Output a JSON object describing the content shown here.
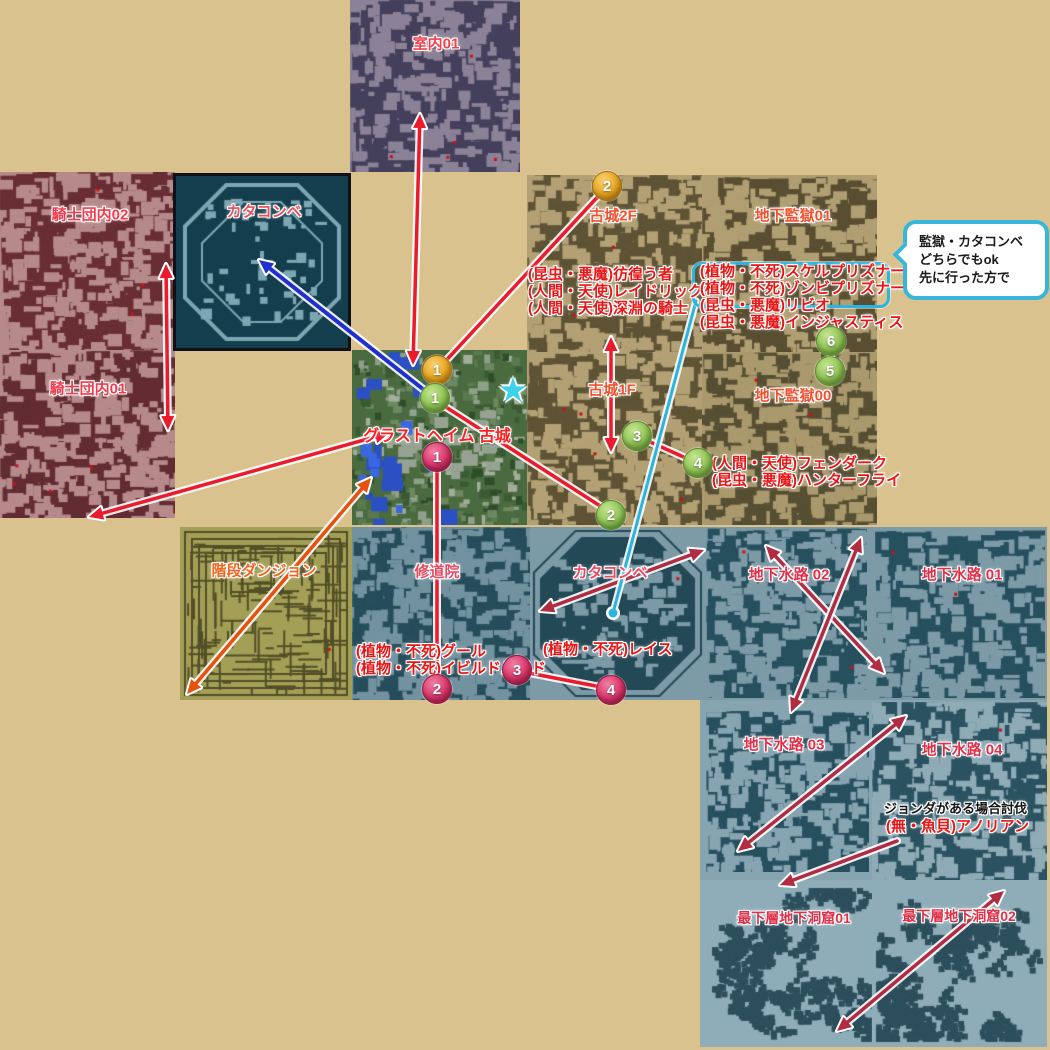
{
  "page": {
    "width": 1050,
    "height": 1050,
    "bg": "#d9c28e",
    "description": "Glast Heim dungeon connection map guide"
  },
  "palette": {
    "red_arrow": "#ea1b2c",
    "crimson_arrow": "#b12c42",
    "orange_arrow": "#e8500e",
    "blue_arrow": "#2030d0",
    "cyan": "#2ab4e0"
  },
  "regions": [
    {
      "name": "region-blue-strip",
      "x": 352,
      "y": 527,
      "w": 695,
      "h": 173,
      "bg": "#7d9aa7"
    },
    {
      "name": "region-sewer-lower",
      "x": 700,
      "y": 700,
      "w": 347,
      "h": 181,
      "bg": "#87a4b1"
    },
    {
      "name": "region-lowest-cave",
      "x": 700,
      "y": 880,
      "w": 347,
      "h": 167,
      "bg": "#8fadb8"
    }
  ],
  "tiles": [
    {
      "name": "room-interior-01",
      "label": "室内01",
      "x": 350,
      "y": 0,
      "w": 170,
      "h": 172,
      "bg": "#8c8297",
      "fg": "#44405c",
      "pattern": "rooms",
      "density": 1.15,
      "dots": 5,
      "lx": 436,
      "ly": 43,
      "lcolor": "#f5404e",
      "lsize": 15
    },
    {
      "name": "knights-hall-02",
      "label": "騎士団内02",
      "x": 0,
      "y": 172,
      "w": 175,
      "h": 178,
      "bg": "#b68a8a",
      "fg": "#682e34",
      "pattern": "rooms",
      "density": 1.35,
      "dots": 3,
      "lx": 90,
      "ly": 214,
      "lcolor": "#f23b4e",
      "lsize": 15
    },
    {
      "name": "knights-hall-01",
      "label": "騎士団内01",
      "x": 0,
      "y": 350,
      "w": 175,
      "h": 168,
      "bg": "#b68a8a",
      "fg": "#622c32",
      "pattern": "rooms",
      "density": 1.35,
      "dots": 4,
      "lx": 88,
      "ly": 388,
      "lcolor": "#f23b4e",
      "lsize": 15
    },
    {
      "name": "catacomb-upper",
      "label": "カタコンベ",
      "x": 176,
      "y": 176,
      "w": 172,
      "h": 172,
      "bg": "#143e4d",
      "fg": "#7ca6b2",
      "pattern": "oct-stroke",
      "dots": 0,
      "border": "3px solid #101018",
      "lx": 264,
      "ly": 211,
      "lcolor": "#e8505e",
      "lsize": 15
    },
    {
      "name": "castle-2f",
      "label": "古城2F",
      "x": 527,
      "y": 175,
      "w": 175,
      "h": 177,
      "bg": "#b3a175",
      "fg": "#5e5335",
      "pattern": "rooms",
      "density": 1.25,
      "dots": 3,
      "lx": 613,
      "ly": 215,
      "lcolor": "#f3502e",
      "lsize": 15
    },
    {
      "name": "underprison-01",
      "label": "地下監獄01",
      "x": 702,
      "y": 175,
      "w": 175,
      "h": 177,
      "bg": "#b09f72",
      "fg": "#594e32",
      "pattern": "rooms",
      "density": 1.25,
      "dots": 3,
      "lx": 793,
      "ly": 215,
      "lcolor": "#f3502e",
      "lsize": 15
    },
    {
      "name": "castle-1f",
      "label": "古城1F",
      "x": 527,
      "y": 352,
      "w": 175,
      "h": 173,
      "bg": "#b3a175",
      "fg": "#5e5335",
      "pattern": "rooms",
      "density": 1.3,
      "dots": 4,
      "lx": 612,
      "ly": 389,
      "lcolor": "#f3502e",
      "lsize": 15
    },
    {
      "name": "underprison-00",
      "label": "地下監獄00",
      "x": 702,
      "y": 352,
      "w": 175,
      "h": 173,
      "bg": "#aa996d",
      "fg": "#564f33",
      "pattern": "rooms",
      "density": 1.3,
      "dots": 2,
      "lx": 793,
      "ly": 395,
      "lcolor": "#f3502e",
      "lsize": 15
    },
    {
      "name": "glast-heim-castle",
      "label": "グラストヘイム 古城",
      "x": 352,
      "y": 350,
      "w": 175,
      "h": 175,
      "bg": "#4a6a40",
      "fg": "#3b5a33",
      "pattern": "glast",
      "dots": 0,
      "lx": 437,
      "ly": 434,
      "lcolor": "#ff2020",
      "lsize": 16
    },
    {
      "name": "stairs-dungeon",
      "label": "階段ダンジョン",
      "x": 180,
      "y": 527,
      "w": 172,
      "h": 173,
      "bg": "#a49f57",
      "fg": "#514f26",
      "pattern": "maze",
      "dots": 1,
      "lx": 264,
      "ly": 570,
      "lcolor": "#f2641c",
      "lsize": 15
    },
    {
      "name": "monastery",
      "label": "修道院",
      "x": 352,
      "y": 527,
      "w": 178,
      "h": 173,
      "bg": "#7392a0",
      "fg": "#264d5b",
      "pattern": "rooms",
      "density": 1.6,
      "dots": 1,
      "lx": 437,
      "ly": 571,
      "lcolor": "#e84a62",
      "lsize": 15
    },
    {
      "name": "catacomb-lower",
      "label": "カタコンベ",
      "x": 530,
      "y": 527,
      "w": 175,
      "h": 173,
      "bg": "#7d9aa7",
      "fg": "#234856",
      "pattern": "oct-fill",
      "dots": 1,
      "lx": 610,
      "ly": 572,
      "lcolor": "#e84a62",
      "lsize": 15
    },
    {
      "name": "sewer-02",
      "label": "地下水路 02",
      "x": 705,
      "y": 528,
      "w": 162,
      "h": 170,
      "bg": "#7d9aa7",
      "fg": "#26505e",
      "pattern": "rooms",
      "density": 1.5,
      "dots": 2,
      "lx": 789,
      "ly": 574,
      "lcolor": "#e0304a",
      "lsize": 15
    },
    {
      "name": "sewer-01",
      "label": "地下水路 01",
      "x": 875,
      "y": 530,
      "w": 170,
      "h": 168,
      "bg": "#7d9aa7",
      "fg": "#26505e",
      "pattern": "rooms",
      "density": 1.5,
      "dots": 2,
      "lx": 962,
      "ly": 574,
      "lcolor": "#e0304a",
      "lsize": 15
    },
    {
      "name": "sewer-03",
      "label": "地下水路 03",
      "x": 706,
      "y": 710,
      "w": 163,
      "h": 162,
      "bg": "#87a4b1",
      "fg": "#27505f",
      "pattern": "rooms",
      "density": 1.5,
      "dots": 0,
      "lx": 784,
      "ly": 744,
      "lcolor": "#e0304a",
      "lsize": 15
    },
    {
      "name": "sewer-04",
      "label": "地下水路 04",
      "x": 872,
      "y": 702,
      "w": 175,
      "h": 178,
      "bg": "#8fabb6",
      "fg": "#2b5260",
      "pattern": "rooms",
      "density": 1.2,
      "dots": 1,
      "lx": 962,
      "ly": 749,
      "lcolor": "#e0304a",
      "lsize": 15
    },
    {
      "name": "lowest-cave-01",
      "label": "最下層地下洞窟01",
      "x": 708,
      "y": 884,
      "w": 168,
      "h": 162,
      "bg": "#8fadb8",
      "fg": "#2d4f5c",
      "pattern": "cave",
      "dots": 0,
      "lx": 794,
      "ly": 918,
      "lcolor": "#e0304a",
      "lsize": 14
    },
    {
      "name": "lowest-cave-02",
      "label": "最下層地下洞窟02",
      "x": 872,
      "y": 884,
      "w": 175,
      "h": 162,
      "bg": "#8fadb8",
      "fg": "#2d4f5c",
      "pattern": "cave",
      "dots": 0,
      "lx": 959,
      "ly": 916,
      "lcolor": "#e0304a",
      "lsize": 14
    }
  ],
  "monster_notes": [
    {
      "name": "castle-2f-monsters",
      "x": 528,
      "y": 266,
      "color": "#e81616",
      "size": 15,
      "lines": [
        "(昆虫・悪魔)彷徨う者",
        "(人間・天使)レイドリック",
        "(人間・天使)深淵の騎士"
      ]
    },
    {
      "name": "underprison-01-monsters",
      "x": 700,
      "y": 263,
      "color": "#e81616",
      "size": 15,
      "lines": [
        "(植物・不死)スケルプリズナー",
        "(植物・不死)ゾンビプリズナー",
        "(昆虫・悪魔)リビオ",
        "(昆虫・悪魔)インジャスティス"
      ]
    },
    {
      "name": "underprison-00-monsters",
      "x": 712,
      "y": 455,
      "color": "#e81616",
      "size": 15,
      "lines": [
        "(人間・天使)フェンダーク",
        "(昆虫・悪魔)ハンターフライ"
      ]
    },
    {
      "name": "monastery-monsters",
      "x": 356,
      "y": 643,
      "color": "#e81616",
      "size": 15,
      "lines": [
        "(植物・不死)グール",
        "(植物・不死)イビルドルイド"
      ]
    },
    {
      "name": "catacomb-monsters",
      "x": 543,
      "y": 641,
      "color": "#e81616",
      "size": 15,
      "lines": [
        "(植物・不死)レイス"
      ]
    },
    {
      "name": "jonda-note",
      "x": 884,
      "y": 800,
      "color": "#141414",
      "size": 13,
      "lines": [
        "ジョンダがある場合討伐"
      ]
    },
    {
      "name": "anolian-note",
      "x": 886,
      "y": 818,
      "color": "#e81616",
      "size": 15,
      "lines": [
        "(無・魚貝)アノリアン"
      ]
    }
  ],
  "circles": [
    {
      "name": "route-orange-1",
      "x": 437,
      "y": 370,
      "n": "1",
      "c": "orange"
    },
    {
      "name": "route-orange-2",
      "x": 607,
      "y": 186,
      "n": "2",
      "c": "orange"
    },
    {
      "name": "route-green-1",
      "x": 435,
      "y": 398,
      "n": "1",
      "c": "green"
    },
    {
      "name": "route-green-2",
      "x": 611,
      "y": 515,
      "n": "2",
      "c": "green"
    },
    {
      "name": "route-green-3",
      "x": 637,
      "y": 436,
      "n": "3",
      "c": "green"
    },
    {
      "name": "route-green-4",
      "x": 698,
      "y": 463,
      "n": "4",
      "c": "green"
    },
    {
      "name": "route-green-5",
      "x": 830,
      "y": 371,
      "n": "5",
      "c": "green"
    },
    {
      "name": "route-green-6",
      "x": 831,
      "y": 341,
      "n": "6",
      "c": "green"
    },
    {
      "name": "route-pink-1",
      "x": 437,
      "y": 457,
      "n": "1",
      "c": "pink"
    },
    {
      "name": "route-pink-2",
      "x": 437,
      "y": 689,
      "n": "2",
      "c": "pink"
    },
    {
      "name": "route-pink-3",
      "x": 517,
      "y": 670,
      "n": "3",
      "c": "pink"
    },
    {
      "name": "route-pink-4",
      "x": 611,
      "y": 690,
      "n": "4",
      "c": "pink"
    }
  ],
  "arrows": [
    {
      "name": "arrow-castle-interior01",
      "x1": 420,
      "y1": 114,
      "x2": 413,
      "y2": 365,
      "c": "#ea1b2c",
      "heads": "both"
    },
    {
      "name": "arrow-knights02-knights01",
      "x1": 166,
      "y1": 264,
      "x2": 168,
      "y2": 430,
      "c": "#ea1b2c",
      "heads": "both"
    },
    {
      "name": "arrow-castle-knights01",
      "x1": 389,
      "y1": 433,
      "x2": 89,
      "y2": 517,
      "c": "#ea1b2c",
      "heads": "both"
    },
    {
      "name": "line-orange1-orange2",
      "x1": 441,
      "y1": 366,
      "x2": 604,
      "y2": 190,
      "c": "#ea1b2c",
      "heads": "none"
    },
    {
      "name": "line-green1-green2",
      "x1": 438,
      "y1": 402,
      "x2": 608,
      "y2": 511,
      "c": "#ea1b2c",
      "heads": "none"
    },
    {
      "name": "line-green3-green4",
      "x1": 648,
      "y1": 441,
      "x2": 688,
      "y2": 459,
      "c": "#ea1b2c",
      "heads": "none"
    },
    {
      "name": "line-green6-green5",
      "x1": 831,
      "y1": 350,
      "x2": 831,
      "y2": 362,
      "c": "#ea1b2c",
      "heads": "none"
    },
    {
      "name": "arrow-castle2f-castle1f",
      "x1": 611,
      "y1": 337,
      "x2": 611,
      "y2": 452,
      "c": "#ea1b2c",
      "heads": "both"
    },
    {
      "name": "line-pink1-pink2",
      "x1": 437,
      "y1": 470,
      "x2": 437,
      "y2": 678,
      "c": "#ea1b2c",
      "heads": "none"
    },
    {
      "name": "line-pink3-pink4",
      "x1": 529,
      "y1": 673,
      "x2": 601,
      "y2": 687,
      "c": "#ea1b2c",
      "heads": "none"
    },
    {
      "name": "arrow-castle-stairsdungeon",
      "x1": 371,
      "y1": 478,
      "x2": 187,
      "y2": 694,
      "c": "#e8500e",
      "heads": "both"
    },
    {
      "name": "arrow-catacomb-sewer02",
      "x1": 704,
      "y1": 550,
      "x2": 540,
      "y2": 611,
      "c": "#b12c42",
      "heads": "both"
    },
    {
      "name": "arrow-sewer02-sewer01-a",
      "x1": 766,
      "y1": 546,
      "x2": 884,
      "y2": 673,
      "c": "#b12c42",
      "heads": "both"
    },
    {
      "name": "arrow-sewer02-sewer03",
      "x1": 861,
      "y1": 538,
      "x2": 791,
      "y2": 712,
      "c": "#b12c42",
      "heads": "both"
    },
    {
      "name": "arrow-sewer03-sewer04",
      "x1": 906,
      "y1": 716,
      "x2": 738,
      "y2": 851,
      "c": "#b12c42",
      "heads": "both"
    },
    {
      "name": "arrow-sewer04-cave01",
      "x1": 897,
      "y1": 841,
      "x2": 780,
      "y2": 885,
      "c": "#b12c42",
      "heads": "end"
    },
    {
      "name": "arrow-cave01-cave02",
      "x1": 1004,
      "y1": 891,
      "x2": 837,
      "y2": 1031,
      "c": "#b12c42",
      "heads": "both"
    },
    {
      "name": "arrow-castle-catacomb-upper",
      "x1": 433,
      "y1": 397,
      "x2": 259,
      "y2": 260,
      "c": "#2030d0",
      "heads": "end",
      "w": 4
    },
    {
      "name": "line-bracket-wraith",
      "x1": 696,
      "y1": 301,
      "x2": 613,
      "y2": 613,
      "c": "#2ab4e0",
      "heads": "none",
      "dot": true,
      "w": 3
    }
  ],
  "bracket": {
    "name": "prisoner-highlight-bracket",
    "x": 692,
    "y": 262,
    "w": 192,
    "h": 40
  },
  "star": {
    "x": 513,
    "y": 392,
    "glyph": "★"
  },
  "bubble": {
    "x": 903,
    "y": 220,
    "w": 146,
    "h": 80,
    "lines": [
      "監獄・カタコンベ",
      "どちらでもok",
      "先に行った方で"
    ]
  }
}
